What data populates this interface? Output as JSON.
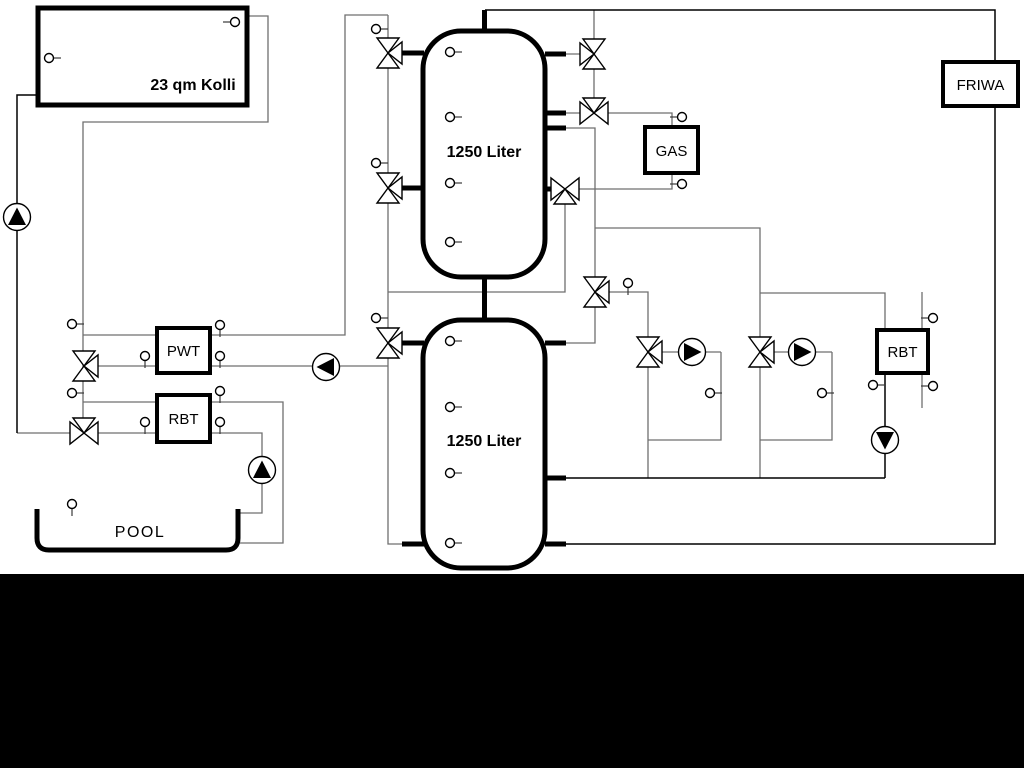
{
  "diagram": {
    "type": "heating-system-schematic",
    "background": "#ffffff",
    "bottom_band_color": "#000000",
    "line_colors": {
      "primary": "#000000",
      "secondary": "#6f6f6f"
    },
    "labels": {
      "collector": "23 qm Kolli",
      "upper_tank": "1250 Liter",
      "lower_tank": "1250 Liter",
      "gas_boiler": "GAS",
      "friwa": "FRIWA",
      "pwt": "PWT",
      "rbt_pool": "RBT",
      "rbt_heating": "RBT",
      "pool": "POOL"
    },
    "symbols": {
      "three_way_valve": "bowtie-with-third-triangle",
      "pump": "circle-with-filled-triangle",
      "sensor": "small-circle-with-stem"
    }
  }
}
